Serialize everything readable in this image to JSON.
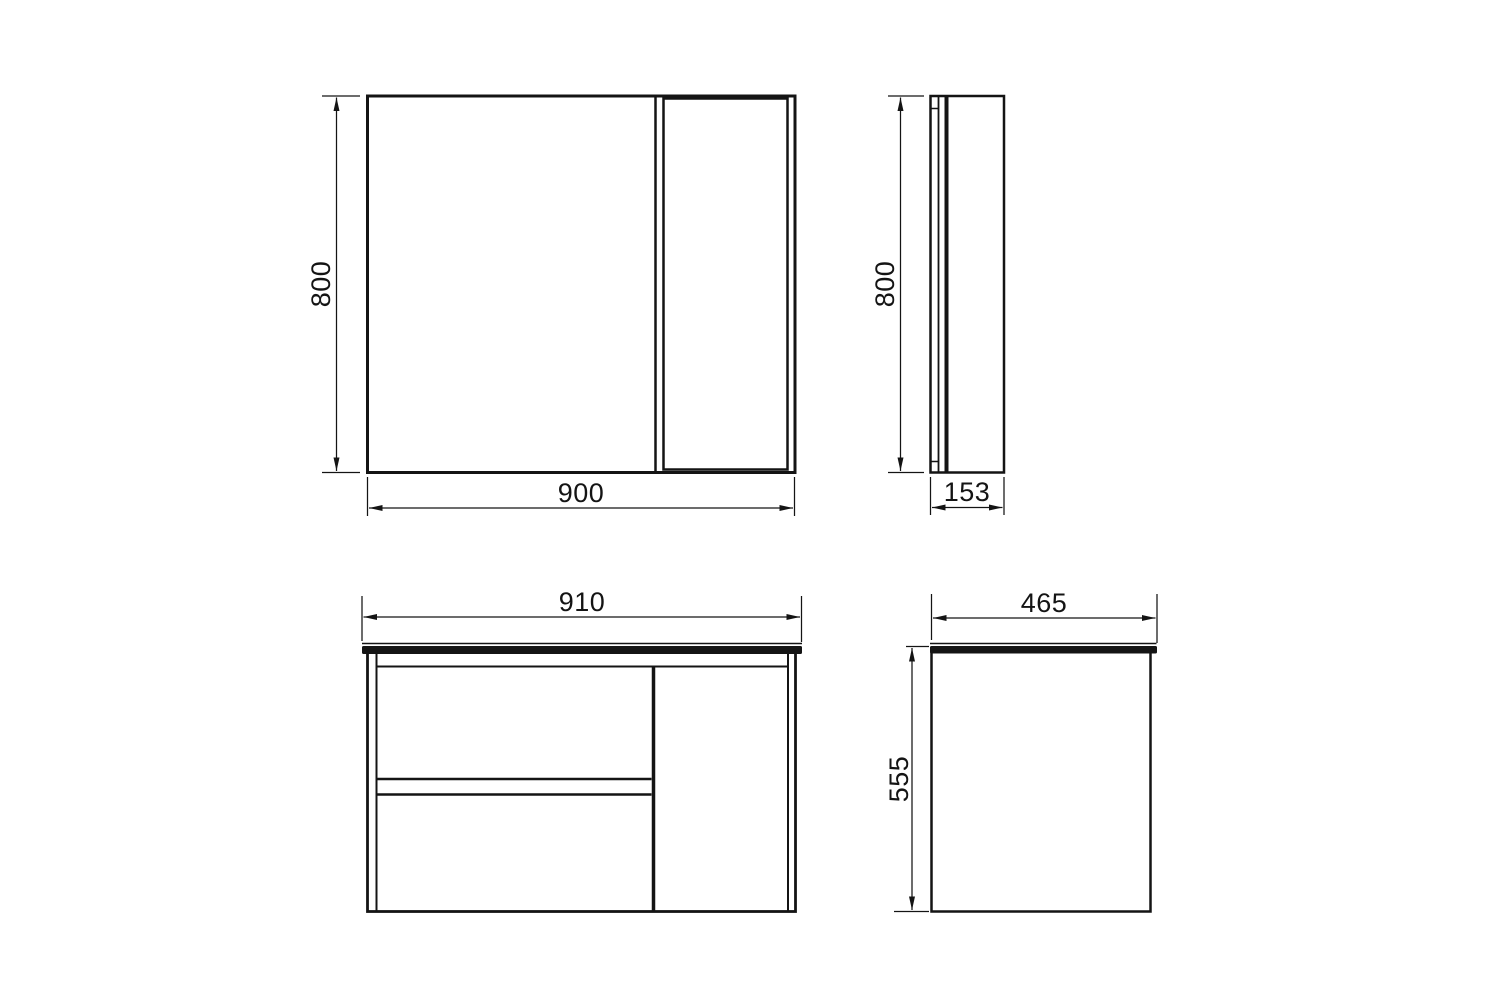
{
  "canvas": {
    "background": "#ffffff",
    "line_color": "#141414"
  },
  "views": {
    "mirror_front": {
      "height_label": "800",
      "width_label": "900"
    },
    "mirror_side": {
      "height_label": "800",
      "depth_label": "153"
    },
    "vanity_front": {
      "width_label": "910"
    },
    "vanity_side": {
      "depth_label": "465",
      "height_label": "555"
    }
  }
}
